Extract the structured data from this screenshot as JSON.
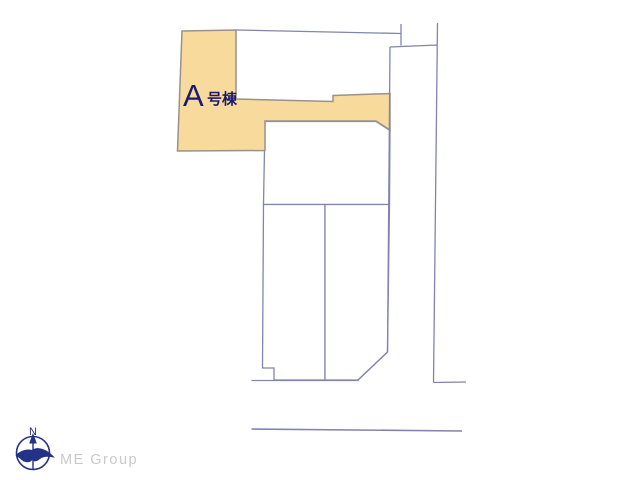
{
  "plot_label": {
    "prefix": "A",
    "suffix": "号棟"
  },
  "compass": {
    "north_label": "N"
  },
  "watermark": {
    "text": "ME Group"
  },
  "colors": {
    "background": "#FFFFFF",
    "highlight": "#F8DA9C",
    "tan_stroke": "#97938A",
    "line": "#8284AE",
    "label_navy": "#1B1B6E",
    "compass_navy": "#233186",
    "watermark_gray": "#C9C9C9"
  }
}
